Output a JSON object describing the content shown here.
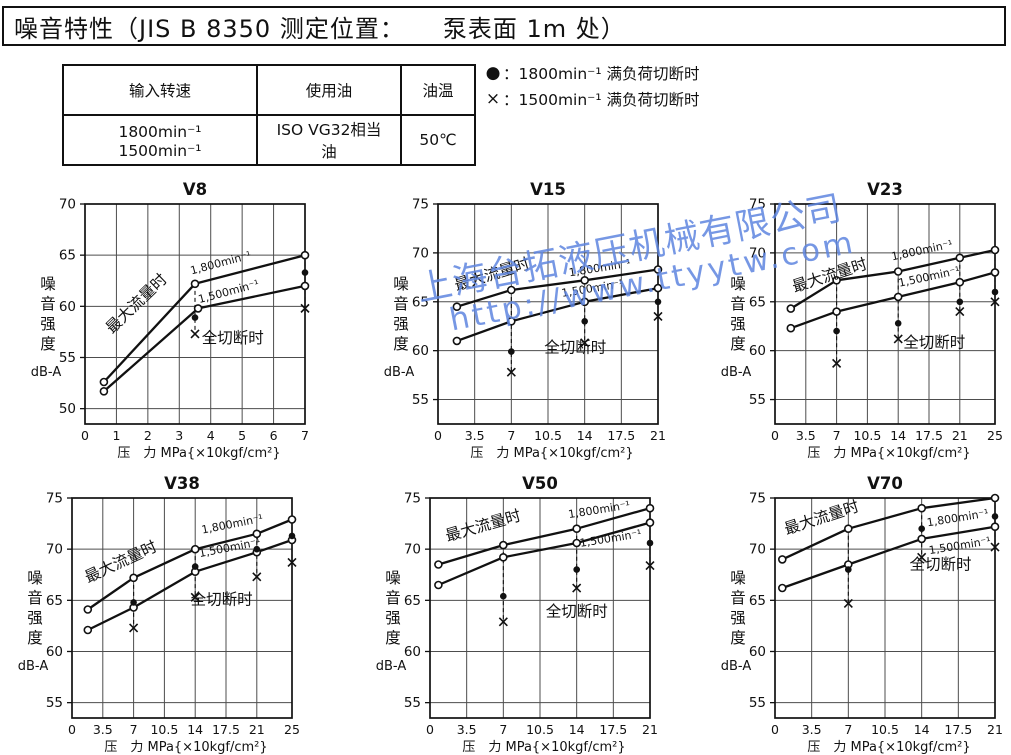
{
  "header": {
    "title": "噪音特性（JIS B 8350 测定位置：　　泵表面 1m 处）"
  },
  "spec_table": {
    "headers": [
      "输入转速",
      "使用油",
      "油温"
    ],
    "row": [
      "1800min⁻¹　1500min⁻¹",
      "ISO VG32相当油",
      "50℃"
    ]
  },
  "legend": {
    "items": [
      {
        "marker": "●",
        "label": "：1800min⁻¹ 满负荷切断时"
      },
      {
        "marker": "×",
        "label": "：1500min⁻¹ 满负荷切断时"
      }
    ]
  },
  "watermark": {
    "line1": "上海台拓液压机械有限公司",
    "line2": "http://www.ttyytw.com",
    "color": "#5f86e0"
  },
  "chart_data": [
    {
      "type": "line",
      "title": "V8",
      "xlabel": "压　力 MPa{×10kgf/cm²}",
      "ylabel": "噪音强度",
      "ylabel_unit": "dB-A",
      "xlim": [
        0,
        7
      ],
      "xticks": [
        "0",
        "1",
        "2",
        "3",
        "4",
        "5",
        "6",
        "7"
      ],
      "ylim": [
        48.5,
        70
      ],
      "yticks": [
        "50",
        "55",
        "60",
        "65",
        "70"
      ],
      "series": [
        {
          "name": "max-flow-1800",
          "marker": "open-circle",
          "points": [
            [
              0.6,
              52.6
            ],
            [
              3.5,
              62.2
            ],
            [
              7,
              65.0
            ]
          ]
        },
        {
          "name": "max-flow-1500",
          "marker": "open-circle",
          "points": [
            [
              0.6,
              51.7
            ],
            [
              3.6,
              59.8
            ],
            [
              7,
              62.0
            ]
          ]
        }
      ],
      "cutoff": {
        "dots_1800": [
          [
            3.5,
            58.9
          ],
          [
            7,
            63.3
          ]
        ],
        "crosses_1500": [
          [
            3.5,
            57.3
          ],
          [
            7,
            59.8
          ]
        ],
        "drops": [
          [
            3.5,
            62.2,
            57.3
          ],
          [
            7,
            65.0,
            59.8
          ]
        ]
      },
      "annotations": [
        {
          "text": "最大流量时",
          "x": 1.75,
          "y": 59.9,
          "rot": -44,
          "size": 15.5
        },
        {
          "text": "1,800min⁻¹",
          "x": 4.35,
          "y": 63.9,
          "rot": -15,
          "size": 11
        },
        {
          "text": "1,500min⁻¹",
          "x": 4.6,
          "y": 61.1,
          "rot": -15,
          "size": 11
        },
        {
          "text": "全切断时",
          "x": 4.7,
          "y": 56.4,
          "rot": 0,
          "size": 15.5
        }
      ]
    },
    {
      "type": "line",
      "title": "V15",
      "xlabel": "压　力 MPa{×10kgf/cm²}",
      "ylabel": "噪音强度",
      "ylabel_unit": "dB-A",
      "xlim": [
        0,
        21
      ],
      "xticks": [
        "0",
        "3.5",
        "7",
        "10.5",
        "14",
        "17.5",
        "21"
      ],
      "ylim": [
        52.5,
        75
      ],
      "yticks": [
        "55",
        "60",
        "65",
        "70",
        "75"
      ],
      "series": [
        {
          "name": "max-flow-1800",
          "marker": "open-circle",
          "points": [
            [
              1.8,
              64.5
            ],
            [
              7,
              66.2
            ],
            [
              14,
              67.2
            ],
            [
              21,
              68.3
            ]
          ]
        },
        {
          "name": "max-flow-1500",
          "marker": "open-circle",
          "points": [
            [
              1.8,
              61.0
            ],
            [
              7,
              63.0
            ],
            [
              14,
              65.0
            ],
            [
              21,
              66.4
            ]
          ]
        }
      ],
      "cutoff": {
        "dots_1800": [
          [
            7,
            59.9
          ],
          [
            14,
            63.0
          ],
          [
            21,
            65.0
          ]
        ],
        "crosses_1500": [
          [
            7,
            57.8
          ],
          [
            14,
            60.8
          ],
          [
            21,
            63.5
          ]
        ],
        "drops": [
          [
            7,
            66.2,
            57.8
          ],
          [
            14,
            67.2,
            60.8
          ],
          [
            21,
            68.3,
            63.5
          ]
        ]
      },
      "annotations": [
        {
          "text": "最大流量时",
          "x": 5.3,
          "y": 67.3,
          "rot": -17,
          "size": 15.5
        },
        {
          "text": "1,800min⁻¹",
          "x": 15.5,
          "y": 68.1,
          "rot": -9,
          "size": 11
        },
        {
          "text": "1,500min⁻¹",
          "x": 14.8,
          "y": 66.0,
          "rot": -9,
          "size": 11
        },
        {
          "text": "全切断时",
          "x": 13.1,
          "y": 59.8,
          "rot": 0,
          "size": 15.5
        }
      ]
    },
    {
      "type": "line",
      "title": "V23",
      "xlabel": "压　力 MPa{×10kgf/cm²}",
      "ylabel": "噪音强度",
      "ylabel_unit": "dB-A",
      "xlim": [
        0,
        25
      ],
      "xticks": [
        "0",
        "3.5",
        "7",
        "10.5",
        "14",
        "17.5",
        "21",
        "25"
      ],
      "ylim": [
        52.5,
        75
      ],
      "yticks": [
        "55",
        "60",
        "65",
        "70",
        "75"
      ],
      "series": [
        {
          "name": "max-flow-1800",
          "marker": "open-circle",
          "points": [
            [
              1.8,
              64.3
            ],
            [
              7,
              67.2
            ],
            [
              14,
              68.1
            ],
            [
              21,
              69.5
            ],
            [
              25,
              70.3
            ]
          ]
        },
        {
          "name": "max-flow-1500",
          "marker": "open-circle",
          "points": [
            [
              1.8,
              62.3
            ],
            [
              7,
              64.0
            ],
            [
              14,
              65.5
            ],
            [
              21,
              67.0
            ],
            [
              25,
              68.0
            ]
          ]
        }
      ],
      "cutoff": {
        "dots_1800": [
          [
            7,
            62.0
          ],
          [
            14,
            62.8
          ],
          [
            21,
            65.0
          ],
          [
            25,
            66.0
          ]
        ],
        "crosses_1500": [
          [
            7,
            58.7
          ],
          [
            14,
            61.2
          ],
          [
            21,
            64.0
          ],
          [
            25,
            65.0
          ]
        ],
        "drops": [
          [
            7,
            67.2,
            58.7
          ],
          [
            14,
            68.1,
            61.2
          ],
          [
            21,
            69.5,
            64.0
          ],
          [
            25,
            70.3,
            65.0
          ]
        ]
      },
      "annotations": [
        {
          "text": "最大流量时",
          "x": 6.4,
          "y": 67.2,
          "rot": -18,
          "size": 15.5
        },
        {
          "text": "1,800min⁻¹",
          "x": 16.8,
          "y": 69.9,
          "rot": -12,
          "size": 11
        },
        {
          "text": "1,500min⁻¹",
          "x": 17.6,
          "y": 67.2,
          "rot": -12,
          "size": 11
        },
        {
          "text": "全切断时",
          "x": 18.1,
          "y": 60.3,
          "rot": 0,
          "size": 15.5
        }
      ]
    },
    {
      "type": "line",
      "title": "V38",
      "xlabel": "压　力 MPa{×10kgf/cm²}",
      "ylabel": "噪音强度",
      "ylabel_unit": "dB-A",
      "xlim": [
        0,
        25
      ],
      "xticks": [
        "0",
        "3.5",
        "7",
        "10.5",
        "14",
        "17.5",
        "21",
        "25"
      ],
      "ylim": [
        53.5,
        75
      ],
      "yticks": [
        "55",
        "60",
        "65",
        "70",
        "75"
      ],
      "series": [
        {
          "name": "max-flow-1800",
          "marker": "open-circle",
          "points": [
            [
              1.8,
              64.1
            ],
            [
              7,
              67.2
            ],
            [
              14,
              70.0
            ],
            [
              21,
              71.5
            ],
            [
              25,
              72.9
            ]
          ]
        },
        {
          "name": "max-flow-1500",
          "marker": "open-circle",
          "points": [
            [
              1.8,
              62.1
            ],
            [
              7,
              64.3
            ],
            [
              14,
              67.8
            ],
            [
              21,
              69.7
            ],
            [
              25,
              70.9
            ]
          ]
        }
      ],
      "cutoff": {
        "dots_1800": [
          [
            7,
            64.8
          ],
          [
            14,
            68.3
          ],
          [
            21,
            70.0
          ],
          [
            25,
            71.3
          ]
        ],
        "crosses_1500": [
          [
            7,
            62.3
          ],
          [
            14,
            65.3
          ],
          [
            21,
            67.3
          ],
          [
            25,
            68.7
          ]
        ],
        "drops": [
          [
            7,
            67.2,
            62.3
          ],
          [
            14,
            70.0,
            65.3
          ],
          [
            21,
            71.5,
            67.3
          ],
          [
            25,
            72.9,
            68.7
          ]
        ]
      },
      "annotations": [
        {
          "text": "最大流量时",
          "x": 5.8,
          "y": 68.3,
          "rot": -25,
          "size": 15.5
        },
        {
          "text": "1,800min⁻¹",
          "x": 18.3,
          "y": 72.1,
          "rot": -11,
          "size": 11
        },
        {
          "text": "1,500min⁻¹",
          "x": 18.0,
          "y": 69.8,
          "rot": -11,
          "size": 11
        },
        {
          "text": "全切断时",
          "x": 17.0,
          "y": 64.6,
          "rot": 0,
          "size": 15.5
        }
      ]
    },
    {
      "type": "line",
      "title": "V50",
      "xlabel": "压　力 MPa{×10kgf/cm²}",
      "ylabel": "噪音强度",
      "ylabel_unit": "dB-A",
      "xlim": [
        0,
        21
      ],
      "xticks": [
        "0",
        "3.5",
        "7",
        "10.5",
        "14",
        "17.5",
        "21"
      ],
      "ylim": [
        53.5,
        75
      ],
      "yticks": [
        "55",
        "60",
        "65",
        "70",
        "75"
      ],
      "series": [
        {
          "name": "max-flow-1800",
          "marker": "open-circle",
          "points": [
            [
              0.8,
              68.5
            ],
            [
              7,
              70.4
            ],
            [
              14,
              72.0
            ],
            [
              21,
              74.0
            ]
          ]
        },
        {
          "name": "max-flow-1500",
          "marker": "open-circle",
          "points": [
            [
              0.8,
              66.5
            ],
            [
              7,
              69.2
            ],
            [
              14,
              70.6
            ],
            [
              21,
              72.6
            ]
          ]
        }
      ],
      "cutoff": {
        "dots_1800": [
          [
            7,
            65.4
          ],
          [
            14,
            68.0
          ],
          [
            21,
            70.6
          ]
        ],
        "crosses_1500": [
          [
            7,
            62.9
          ],
          [
            14,
            66.2
          ],
          [
            21,
            68.4
          ]
        ],
        "drops": [
          [
            7,
            70.4,
            62.9
          ],
          [
            14,
            72.0,
            66.2
          ],
          [
            21,
            74.0,
            68.4
          ]
        ]
      },
      "annotations": [
        {
          "text": "最大流量时",
          "x": 5.2,
          "y": 71.8,
          "rot": -16,
          "size": 15.5
        },
        {
          "text": "1,800min⁻¹",
          "x": 16.2,
          "y": 73.5,
          "rot": -9,
          "size": 11
        },
        {
          "text": "1,500min⁻¹",
          "x": 17.3,
          "y": 70.7,
          "rot": -9,
          "size": 11
        },
        {
          "text": "全切断时",
          "x": 14.0,
          "y": 63.4,
          "rot": 0,
          "size": 15.5
        }
      ]
    },
    {
      "type": "line",
      "title": "V70",
      "xlabel": "压　力 MPa{×10kgf/cm²}",
      "ylabel": "噪音强度",
      "ylabel_unit": "dB-A",
      "xlim": [
        0,
        21
      ],
      "xticks": [
        "0",
        "3.5",
        "7",
        "10.5",
        "14",
        "17.5",
        "21"
      ],
      "ylim": [
        53.5,
        75
      ],
      "yticks": [
        "55",
        "60",
        "65",
        "70",
        "75"
      ],
      "series": [
        {
          "name": "max-flow-1800",
          "marker": "open-circle",
          "points": [
            [
              0.7,
              69.0
            ],
            [
              7,
              72.0
            ],
            [
              14,
              74.0
            ],
            [
              21,
              75.0
            ]
          ]
        },
        {
          "name": "max-flow-1500",
          "marker": "open-circle",
          "points": [
            [
              0.7,
              66.2
            ],
            [
              7,
              68.5
            ],
            [
              14,
              71.0
            ],
            [
              21,
              72.2
            ]
          ]
        }
      ],
      "cutoff": {
        "dots_1800": [
          [
            7,
            68.0
          ],
          [
            14,
            72.0
          ],
          [
            21,
            73.2
          ]
        ],
        "crosses_1500": [
          [
            7,
            64.7
          ],
          [
            14,
            69.2
          ],
          [
            21,
            70.2
          ]
        ],
        "drops": [
          [
            7,
            72.0,
            64.7
          ],
          [
            14,
            74.0,
            69.2
          ],
          [
            21,
            75.0,
            70.2
          ]
        ]
      },
      "annotations": [
        {
          "text": "最大流量时",
          "x": 4.6,
          "y": 72.6,
          "rot": -18,
          "size": 15.5
        },
        {
          "text": "1,800min⁻¹",
          "x": 17.5,
          "y": 72.7,
          "rot": -9,
          "size": 11
        },
        {
          "text": "1,500min⁻¹",
          "x": 17.7,
          "y": 70.0,
          "rot": -9,
          "size": 11
        },
        {
          "text": "全切断时",
          "x": 15.8,
          "y": 68.0,
          "rot": 0,
          "size": 15.5
        }
      ]
    }
  ]
}
